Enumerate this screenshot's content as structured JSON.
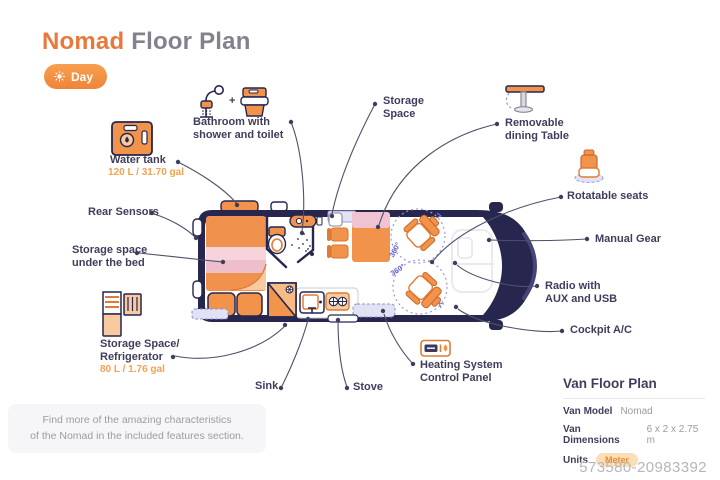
{
  "header": {
    "title_accent": "Nomad",
    "title_rest": " Floor Plan",
    "day_toggle": "Day"
  },
  "icons_glue": {
    "plus": "+"
  },
  "callouts": {
    "bathroom": "Bathroom with\nshower and toilet",
    "storage_space": "Storage\nSpace",
    "dining_table": "Removable\ndining Table",
    "rotatable_seats": "Rotatable seats",
    "manual_gear": "Manual Gear",
    "radio": "Radio with\nAUX and USB",
    "cockpit_ac": "Cockpit A/C",
    "heating": "Heating System\nControl Panel",
    "stove": "Stove",
    "sink": "Sink",
    "water_tank": "Water tank",
    "water_tank_capacity": "120 L / 31.70 gal",
    "fridge": "Storage Space/\nRefrigerator",
    "fridge_capacity": "80 L / 1.76 gal",
    "under_bed": "Storage space\nunder the bed",
    "rear_sensors": "Rear Sensors"
  },
  "floorplan": {
    "rotation_top": "360°",
    "rotation_bottom": "360°"
  },
  "note": "Find more of the amazing characteristics\nof the Nomad in the included features section.",
  "spec_panel": {
    "title": "Van Floor Plan",
    "rows": [
      {
        "label": "Van Model",
        "value": "Nomad"
      },
      {
        "label": "Van Dimensions",
        "value": "6 x 2 x 2.75 m"
      },
      {
        "label": "Units",
        "value": "Meter"
      }
    ]
  },
  "watermark": "573580-20983392",
  "colors": {
    "accent_orange": "#F08A3C",
    "navy": "#26264E",
    "pink": "#F2C3CF",
    "lavender": "#E2E2F5"
  }
}
